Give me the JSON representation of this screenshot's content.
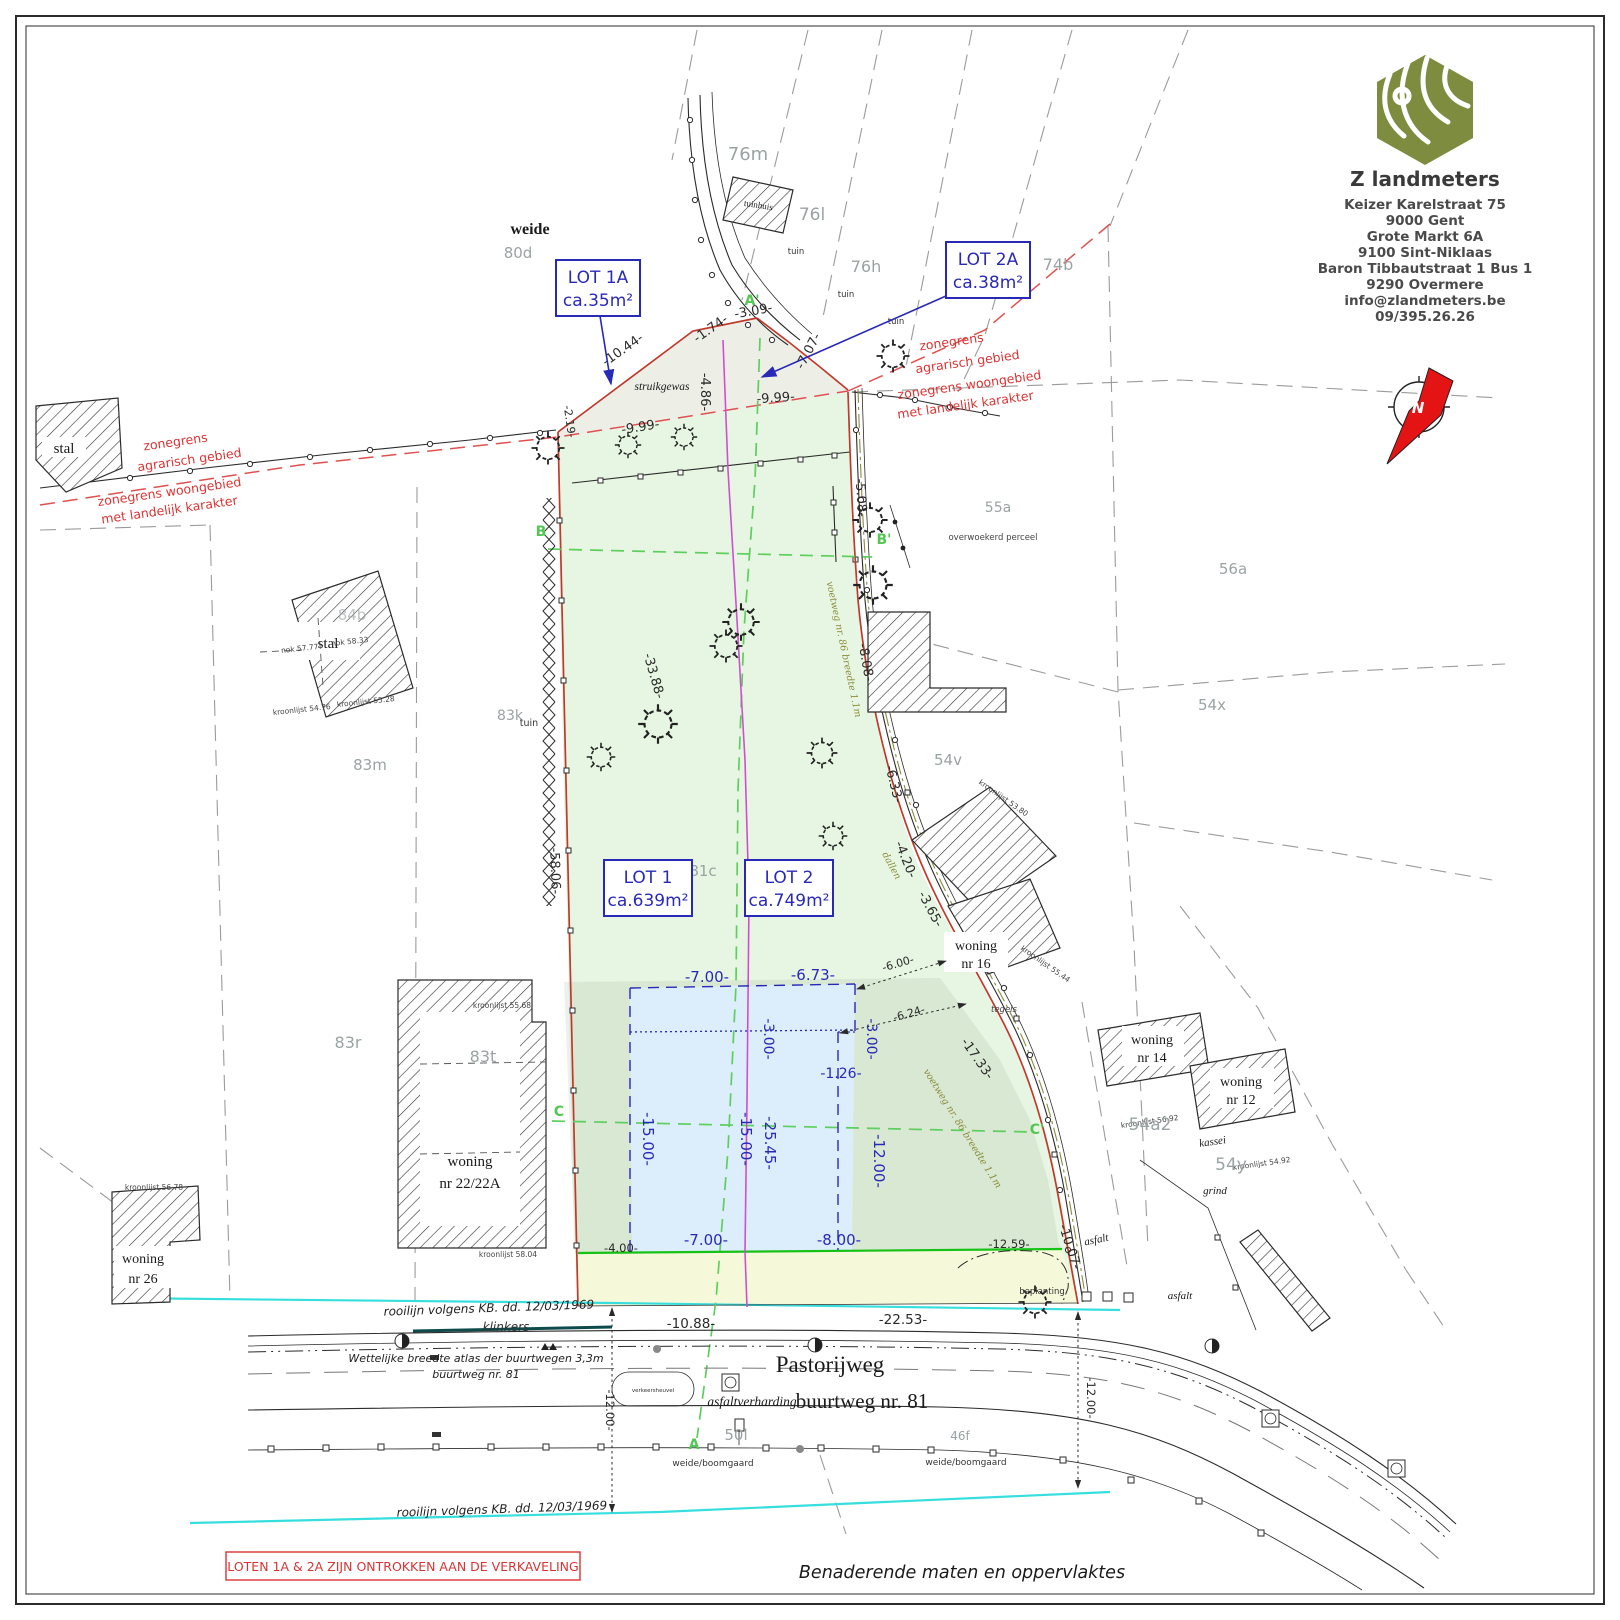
{
  "colors": {
    "accent_blue": "#2929b8",
    "boundary_red": "#c03a2c",
    "zone_dash_red": "#e05050",
    "note_red": "#d83434",
    "rooilijn_cyan": "#36dede",
    "front_line_green": "#17c217",
    "section_green": "#5ecf5e",
    "division_magenta": "#cf4fcf",
    "voetweg_olive": "#8b8b3a",
    "logo_green": "#7d8c3f",
    "lot_fill": "#e7f6e2",
    "envelope_fill": "#dceefb",
    "wedge_fill": "#edefe7",
    "strip_fill": "#f5f9d9"
  },
  "title_block": {
    "company": "Z landmeters",
    "lines": [
      "Keizer Karelstraat 75",
      "9000 Gent",
      "Grote Markt 6A",
      "9100 Sint-Niklaas",
      "Baron Tibbautstraat 1 Bus 1",
      "9290 Overmere",
      "info@zlandmeters.be",
      "09/395.26.26"
    ]
  },
  "north": {
    "label": "N"
  },
  "lots": {
    "lot1a": {
      "name": "LOT 1A",
      "area": "ca.35m²"
    },
    "lot2a": {
      "name": "LOT 2A",
      "area": "ca.38m²"
    },
    "lot1": {
      "name": "LOT 1",
      "area": "ca.639m²"
    },
    "lot2": {
      "name": "LOT 2",
      "area": "ca.749m²"
    }
  },
  "zones": {
    "agrarisch_1": "zonegrens",
    "agrarisch_2": "agrarisch gebied",
    "woongebied_1": "zonegrens woongebied",
    "woongebied_2": "met landelijk karakter"
  },
  "parcels": {
    "76m": "76m",
    "76l": "76l",
    "76h": "76h",
    "74b": "74b",
    "80d": "80d",
    "55a": "55a",
    "56a": "56a",
    "54x": "54x",
    "54v": "54v",
    "83k": "83k",
    "83m": "83m",
    "83r": "83r",
    "83t": "83t",
    "81c": "81c",
    "54a2": "54a2",
    "54y": "54y",
    "50l": "50l",
    "46f": "46f",
    "84b": "84b"
  },
  "buildings": {
    "stal": "stal",
    "tuinhuis": "tuinhuis",
    "woning": "woning",
    "nr16": "nr 16",
    "nr14": "nr 14",
    "nr12": "nr 12",
    "nr2222a": "nr 22/22A",
    "nr26": "nr 26"
  },
  "roof_labels": {
    "nok5777": "nok 57.77",
    "nok5833": "nok 58.33",
    "kr5476": "kroonlijst 54.76",
    "kr5528": "kroonlijst 55.28",
    "kr5568": "kroonlijst 55.68",
    "kr5804": "kroonlijst 58.04",
    "kr5678": "kroonlijst 56.78",
    "kr5380": "kroonlijst 53.80",
    "kr5544": "kroonlijst 55.44",
    "kr5692": "kroonlijst 56.92",
    "kr5492": "kroonlijst 54.92"
  },
  "terrain": {
    "weide": "weide",
    "struikgewas": "struikgewas",
    "tuin": "tuin",
    "overwoekerd": "overwoekerd perceel",
    "tegels": "tegels",
    "kassei": "kassei",
    "grind": "grind",
    "asfalt": "asfalt",
    "beplanting": "beplanting",
    "klinkers": "klinkers",
    "weide_boomgaard": "weide/boomgaard",
    "dallen": "dallen",
    "voetweg": "voetweg nr. 86 breedte 1.1m"
  },
  "roads": {
    "pastorijweg": "Pastorijweg",
    "buurtweg": "buurtweg nr. 81",
    "asfaltverharding": "asfaltverharding",
    "wettelijke_1": "Wettelijke breedte atlas der buurtwegen 3,3m",
    "wettelijke_2": "buurtweg nr. 81",
    "rooilijn": "rooilijn volgens KB. dd. 12/03/1969",
    "verkeersheuvel": "verkeersheuvel"
  },
  "sections": {
    "b": "B",
    "b2": "B'",
    "c": "C",
    "c2": "C'",
    "a": "A",
    "a2": "A'"
  },
  "dims": {
    "d1044": "-10.44-",
    "d174": "-1.74-",
    "d309": "-3.09-",
    "d707": "-7.07-",
    "d486": "-4.86-",
    "d999": "-9.99-",
    "d219": "-2.19-",
    "d508": "-5.08-",
    "d808": "-8.08-",
    "d3388": "-33.88-",
    "d5806": "-58.06-",
    "d633": "-6.33-",
    "d420": "-4.20-",
    "d365": "-3.65-",
    "d1733": "-17.33-",
    "d1007": "-10.07-",
    "d600": "-6.00-",
    "d624": "-6.24-",
    "d400": "-4.00-",
    "d1259": "-12.59-",
    "d1088": "-10.88-",
    "d2253": "-22.53-",
    "d1200": "-12.00-",
    "d700": "-7.00-",
    "d673": "-6.73-",
    "d300": "-3.00-",
    "d126": "-1.26-",
    "d1500": "-15.00-",
    "d2545": "-25.45-",
    "d800": "-8.00-"
  },
  "notes": {
    "excluded": "LOTEN 1A & 2A ZIJN ONTROKKEN AAN DE VERKAVELING",
    "approx": "Benaderende maten en oppervlaktes"
  }
}
